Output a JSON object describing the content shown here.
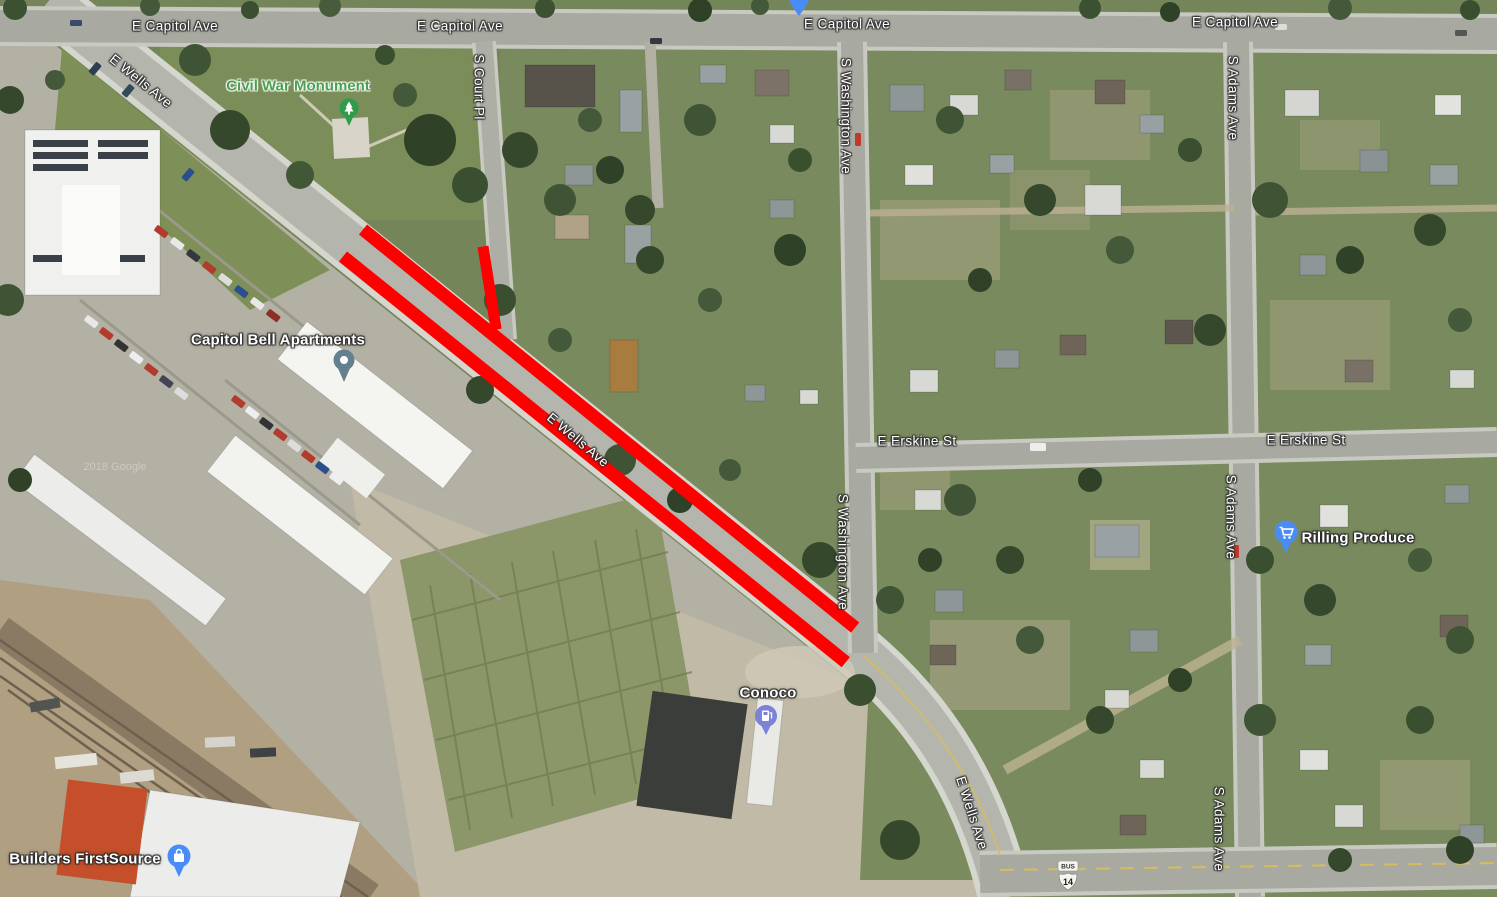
{
  "roads": {
    "e_capitol_ave": "E Capitol Ave",
    "e_wells_ave": "E Wells Ave",
    "s_court_pl": "S Court Pl",
    "s_washington_ave": "S Washington Ave",
    "e_erskine_st": "E Erskine St",
    "s_adams_ave": "S Adams Ave"
  },
  "places": {
    "civil_war_monument": "Civil War Monument",
    "capitol_bell_apartments": "Capitol Bell Apartments",
    "conoco": "Conoco",
    "rilling_produce": "Rilling Produce",
    "builders_firstsource": "Builders FirstSource"
  },
  "highway_shield": {
    "banner": "BUS",
    "route": "14"
  },
  "watermark": "2018 Google",
  "colors": {
    "closure_red": "#ff0000",
    "poi_blue": "#4a8cf5",
    "monument_green": "#2e9d4b",
    "conoco_purple": "#7b82d8",
    "apartments_gray_blue": "#64808e"
  }
}
